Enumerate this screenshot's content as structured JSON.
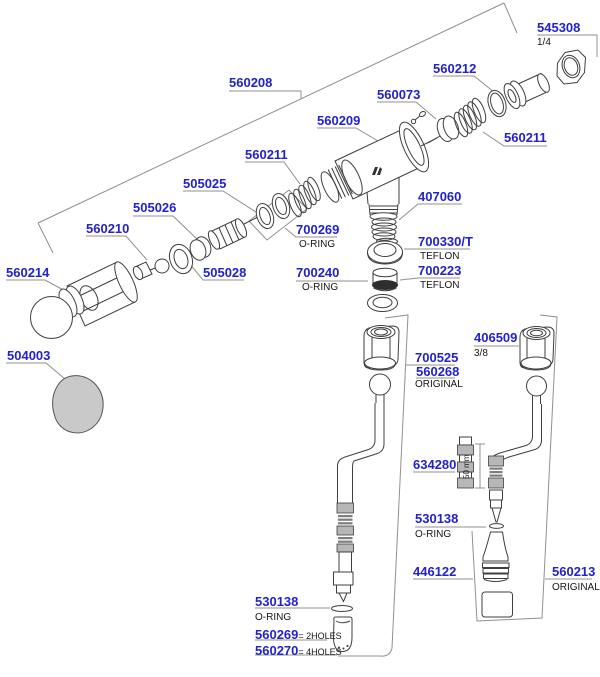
{
  "diagram": {
    "type": "exploded-parts-diagram",
    "colors": {
      "label_blue": "#2222cc",
      "leader_gray": "#909090",
      "art_line": "#3f3f3f",
      "band_gray": "#b7b7b7",
      "knob_gray": "#c9c9c9"
    },
    "labels": {
      "560208": {
        "number": "560208"
      },
      "545308": {
        "number": "545308",
        "note": "1/4"
      },
      "560212": {
        "number": "560212"
      },
      "560073": {
        "number": "560073"
      },
      "560209": {
        "number": "560209"
      },
      "560211_right": {
        "number": "560211"
      },
      "560211_left": {
        "number": "560211"
      },
      "505025": {
        "number": "505025"
      },
      "505026": {
        "number": "505026"
      },
      "560210": {
        "number": "560210"
      },
      "700269": {
        "number": "700269",
        "note": "O-RING"
      },
      "407060": {
        "number": "407060"
      },
      "700330T": {
        "number": "700330/T",
        "note": "TEFLON"
      },
      "560214": {
        "number": "560214"
      },
      "505028": {
        "number": "505028"
      },
      "700240": {
        "number": "700240",
        "note": "O-RING"
      },
      "700223": {
        "number": "700223",
        "note": "TEFLON"
      },
      "504003": {
        "number": "504003"
      },
      "700525": {
        "number": "700525"
      },
      "560268": {
        "number": "560268",
        "note": "ORIGINAL"
      },
      "406509": {
        "number": "406509",
        "note": "3/8"
      },
      "634280": {
        "number": "634280"
      },
      "530138_right": {
        "number": "530138",
        "note": "O-RING"
      },
      "446122": {
        "number": "446122"
      },
      "560213": {
        "number": "560213",
        "note": "ORIGINAL"
      },
      "530138_left": {
        "number": "530138",
        "note": "O-RING"
      },
      "560269": {
        "number": "560269",
        "eq_note": "= 2HOLES"
      },
      "560270": {
        "number": "560270",
        "eq_note": "= 4HOLES"
      }
    },
    "dimension_note": "50 mm"
  }
}
